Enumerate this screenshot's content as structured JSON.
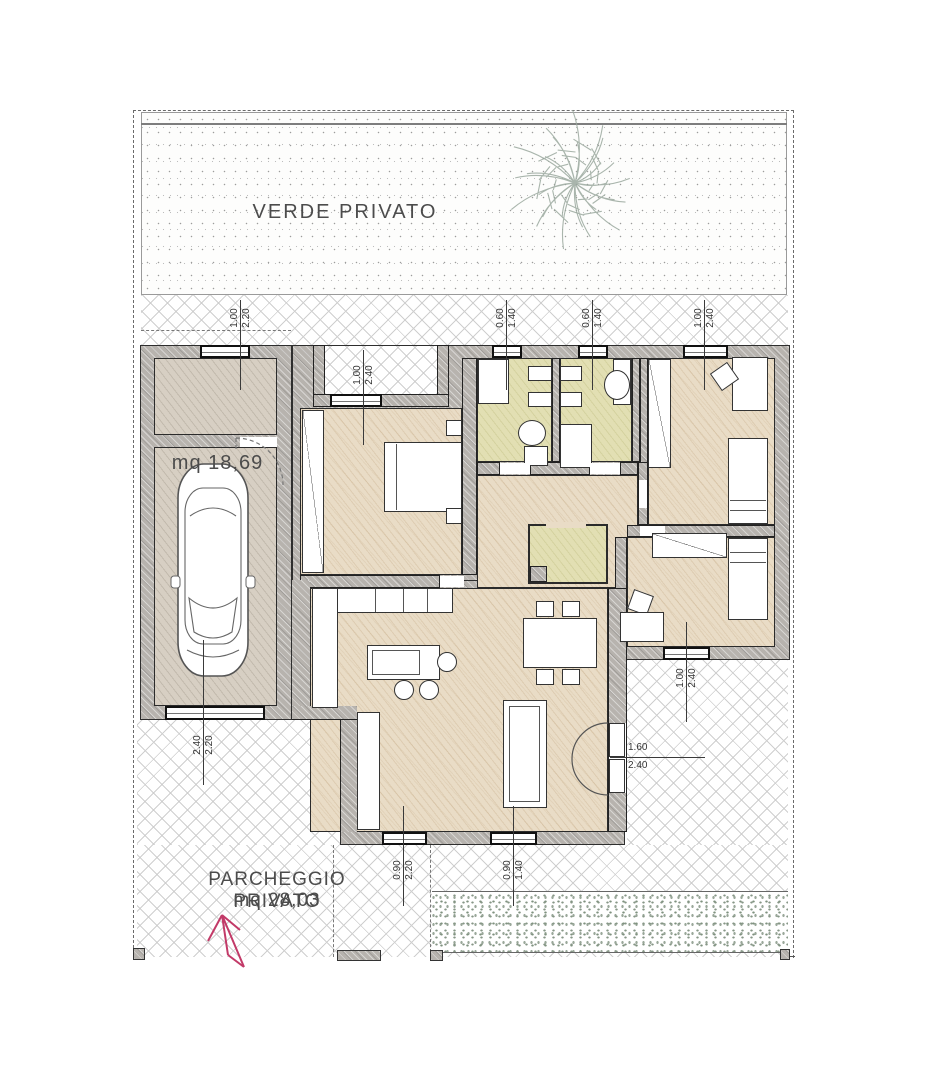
{
  "labels": {
    "garden": "VERDE PRIVATO",
    "garage_area": "mq 18,69",
    "parking": "PARCHEGGIO PRIVATO",
    "parking_area": "mq 28,03"
  },
  "dimensions": [
    {
      "id": "garage-window",
      "a": "1.00",
      "b": "2.20",
      "orientation": "vertical"
    },
    {
      "id": "entrance-door",
      "a": "1.00",
      "b": "2.40",
      "orientation": "vertical"
    },
    {
      "id": "bath1-window",
      "a": "0.60",
      "b": "1.40",
      "orientation": "vertical"
    },
    {
      "id": "bath2-window",
      "a": "0.60",
      "b": "1.40",
      "orientation": "vertical"
    },
    {
      "id": "bedroom1-window",
      "a": "1.00",
      "b": "2.40",
      "orientation": "vertical"
    },
    {
      "id": "bedroom2-window",
      "a": "1.00",
      "b": "2.40",
      "orientation": "vertical"
    },
    {
      "id": "french-door",
      "a": "1.60",
      "b": "2.40",
      "orientation": "horizontal"
    },
    {
      "id": "garage-door",
      "a": "2.40",
      "b": "2.20",
      "orientation": "vertical"
    },
    {
      "id": "living-door",
      "a": "0.90",
      "b": "2.20",
      "orientation": "vertical"
    },
    {
      "id": "living-window",
      "a": "0.90",
      "b": "1.40",
      "orientation": "vertical"
    }
  ],
  "colors": {
    "wall_gray": "#b7b3ae",
    "floor_tan": "#e9dcc6",
    "floor_olive": "#e2dfb3",
    "floor_garage": "#d7cfc3",
    "hedge_green": "#879787",
    "tree_green": "#9aa89e",
    "arrow_magenta": "#c23a68",
    "line_dark": "#2e2e2e"
  }
}
